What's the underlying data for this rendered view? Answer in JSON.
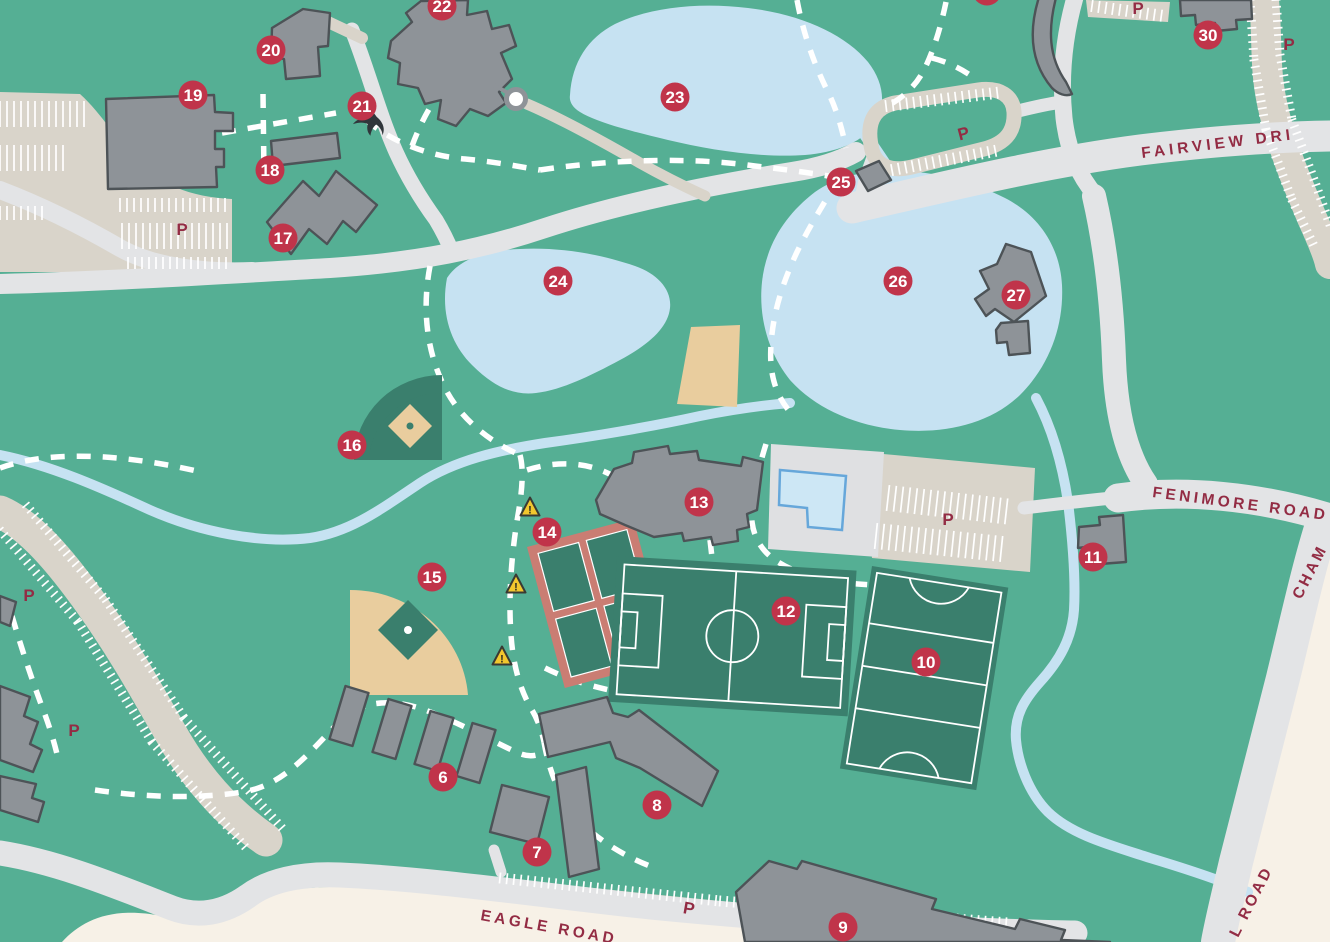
{
  "map": {
    "type": "campus-map",
    "description": "illustrated campus map with numbered building markers"
  },
  "colors": {
    "background_green": "#55af94",
    "water_blue": "#c6e2f2",
    "road_gray": "#e3e4e6",
    "parking_beige": "#d9d4ca",
    "deck_gray": "#dfe0e2",
    "offmap_cream": "#f7f1e7",
    "building_gray": "#8e9398",
    "building_stroke": "#4d5357",
    "field_green": "#3a7f6d",
    "field_tan": "#e9cd9e",
    "tennis_salmon": "#ca7d73",
    "marker_red": "#c0344a",
    "label_maroon": "#932c44",
    "path_white": "#ffffff",
    "warning_yellow": "#f2c72e",
    "pool_blue": "#cde7f5",
    "pool_stroke": "#66a7da",
    "bird_black": "#30363b"
  },
  "markers": [
    {
      "label": "6",
      "x": 443,
      "y": 777
    },
    {
      "label": "7",
      "x": 537,
      "y": 852
    },
    {
      "label": "8",
      "x": 657,
      "y": 805
    },
    {
      "label": "9",
      "x": 843,
      "y": 927
    },
    {
      "label": "10",
      "x": 926,
      "y": 662
    },
    {
      "label": "11",
      "x": 1093,
      "y": 557
    },
    {
      "label": "12",
      "x": 786,
      "y": 611
    },
    {
      "label": "13",
      "x": 699,
      "y": 502
    },
    {
      "label": "14",
      "x": 547,
      "y": 532
    },
    {
      "label": "15",
      "x": 432,
      "y": 577
    },
    {
      "label": "16",
      "x": 352,
      "y": 445
    },
    {
      "label": "17",
      "x": 283,
      "y": 238
    },
    {
      "label": "18",
      "x": 270,
      "y": 170
    },
    {
      "label": "19",
      "x": 193,
      "y": 95
    },
    {
      "label": "20",
      "x": 271,
      "y": 50
    },
    {
      "label": "21",
      "x": 362,
      "y": 106
    },
    {
      "label": "22",
      "x": 442,
      "y": 6
    },
    {
      "label": "23",
      "x": 675,
      "y": 97
    },
    {
      "label": "24",
      "x": 558,
      "y": 281
    },
    {
      "label": "25",
      "x": 841,
      "y": 182
    },
    {
      "label": "26",
      "x": 898,
      "y": 281
    },
    {
      "label": "27",
      "x": 1016,
      "y": 295
    },
    {
      "label": "30",
      "x": 1208,
      "y": 35
    },
    {
      "label": "",
      "x": 987,
      "y": -9
    }
  ],
  "parking_labels": [
    {
      "text": "P",
      "x": 182,
      "y": 235,
      "rotation": 0
    },
    {
      "text": "P",
      "x": 29,
      "y": 601,
      "rotation": 0
    },
    {
      "text": "P",
      "x": 74,
      "y": 736,
      "rotation": 0
    },
    {
      "text": "P",
      "x": 688,
      "y": 914,
      "rotation": 10
    },
    {
      "text": "P",
      "x": 948,
      "y": 525,
      "rotation": 0
    },
    {
      "text": "P",
      "x": 965,
      "y": 139,
      "rotation": -15
    },
    {
      "text": "P",
      "x": 1138,
      "y": 14,
      "rotation": 0
    },
    {
      "text": "P",
      "x": 1289,
      "y": 50,
      "rotation": 0
    }
  ],
  "road_labels": [
    {
      "text": "FAIRVIEW DRI",
      "x": 1142,
      "y": 158,
      "rotation": -7,
      "spacing": 4
    },
    {
      "text": "FENIMORE ROAD",
      "x": 1152,
      "y": 497,
      "rotation": 7.5,
      "spacing": 3.5
    },
    {
      "text": "EAGLE ROAD",
      "x": 480,
      "y": 920,
      "rotation": 10,
      "spacing": 3.5
    },
    {
      "text": "CHAM",
      "x": 1301,
      "y": 600,
      "rotation": -63,
      "spacing": 3
    },
    {
      "text": "L ROAD",
      "x": 1238,
      "y": 938,
      "rotation": -63,
      "spacing": 3
    }
  ],
  "icons": {
    "warning_glyph": "!",
    "warnings": [
      {
        "x": 530,
        "y": 508
      },
      {
        "x": 516,
        "y": 585
      },
      {
        "x": 502,
        "y": 657
      }
    ],
    "bird": {
      "x": 375,
      "y": 118
    }
  }
}
